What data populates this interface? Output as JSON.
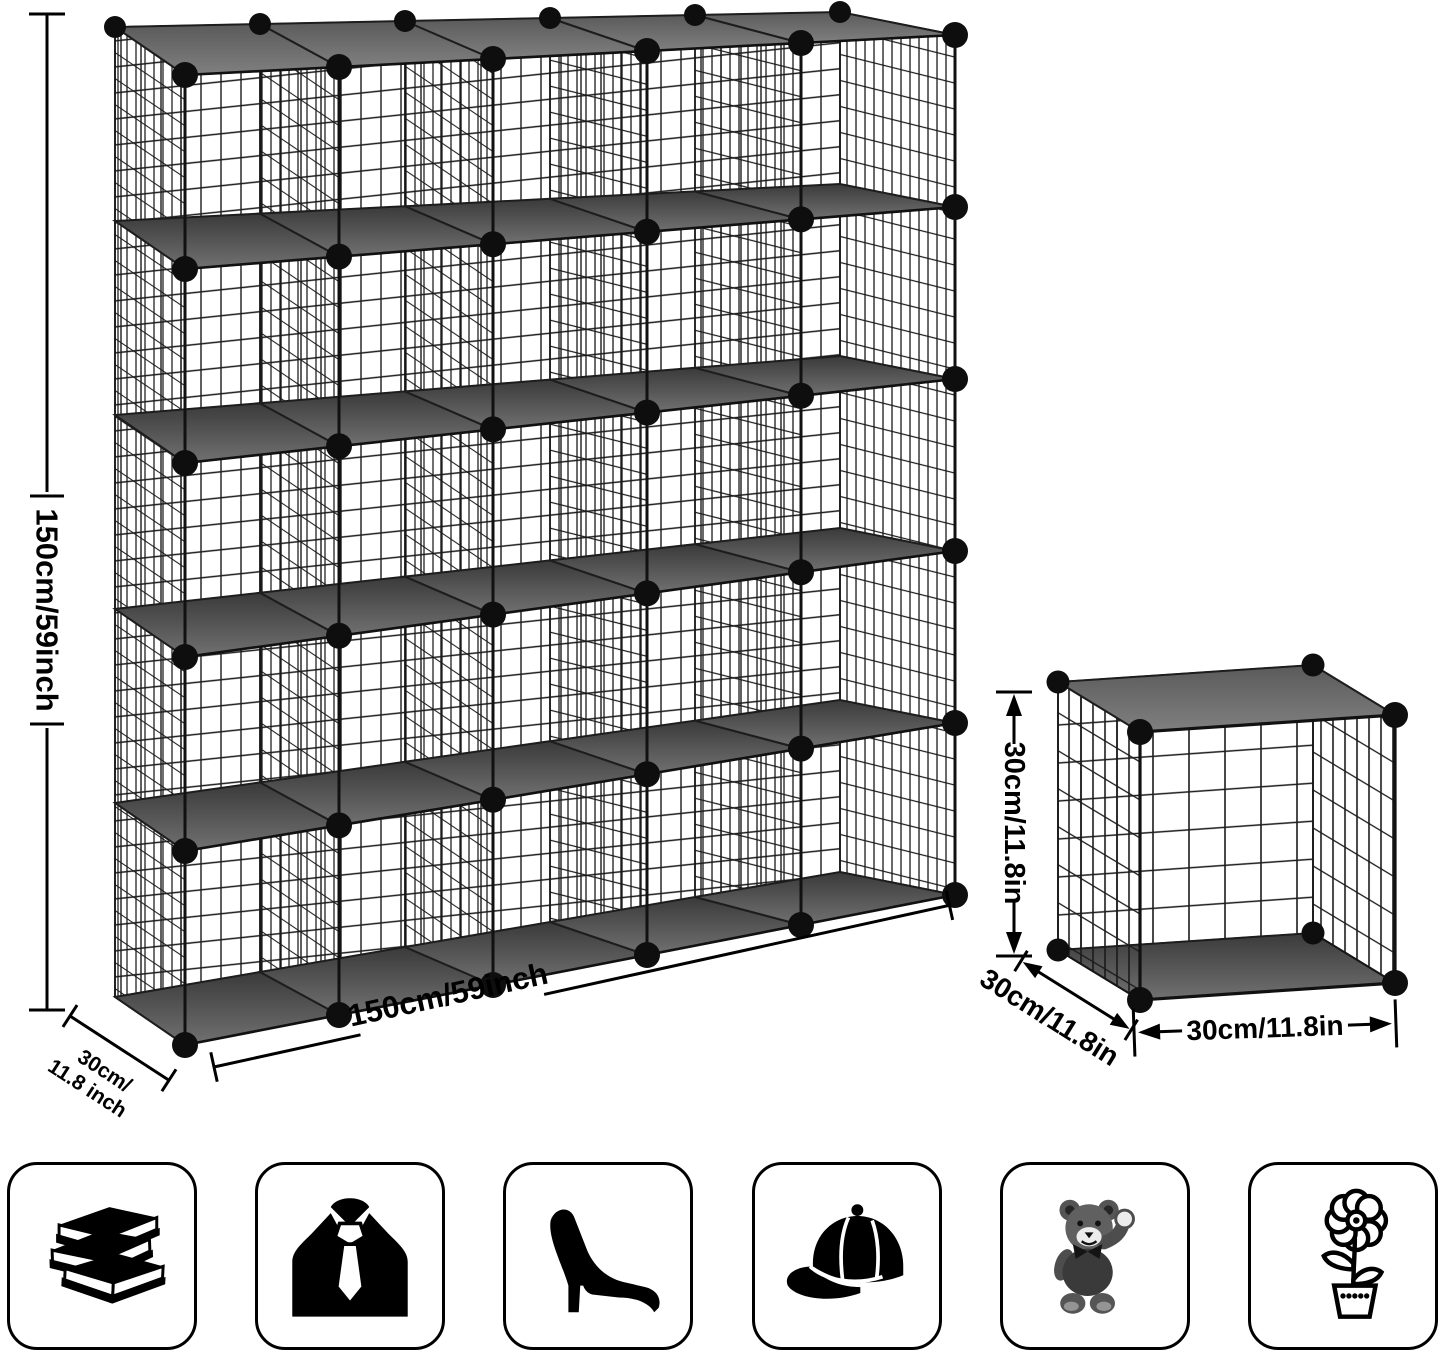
{
  "colors": {
    "background": "#ffffff",
    "wire": "#1a1a1a",
    "ball": "#0e0e0e",
    "panel_dark": "#3a3a3a",
    "panel_light": "#757575",
    "ink": "#000000"
  },
  "main_unit": {
    "columns": 5,
    "rows": 5,
    "height_label": "150cm/59inch",
    "width_label": "150cm/59inch",
    "depth_label_line1": "30cm/",
    "depth_label_line2": "11.8 inch"
  },
  "single_cube": {
    "height_label": "30cm/11.8in",
    "depth_label": "30cm/11.8in",
    "width_label": "30cm/11.8in"
  },
  "category_icons": [
    {
      "name": "books"
    },
    {
      "name": "suit-and-tie"
    },
    {
      "name": "high-heel-shoe"
    },
    {
      "name": "baseball-cap"
    },
    {
      "name": "teddy-bear"
    },
    {
      "name": "potted-flower"
    }
  ]
}
